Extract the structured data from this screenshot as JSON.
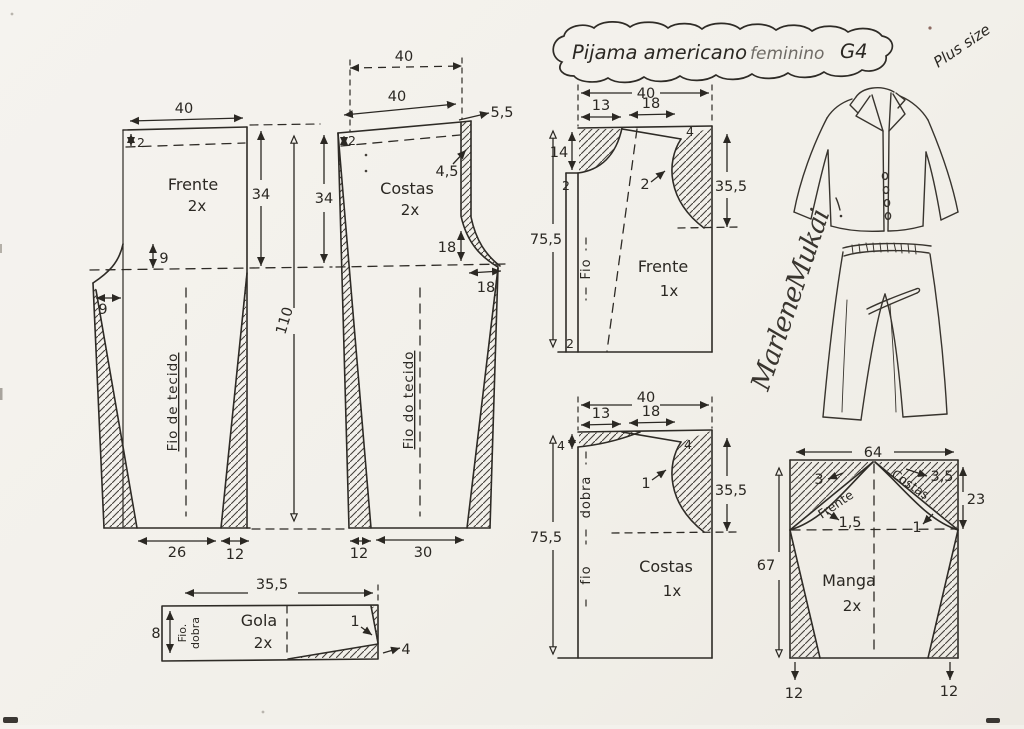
{
  "title": {
    "name": "Pijama americano",
    "audience": "feminino",
    "size": "G4",
    "plus": "Plus size"
  },
  "signature": "MarleneMukai",
  "pants_front": {
    "label": "Frente",
    "qty": "2x",
    "grain": "Fio de tecido",
    "waist": "40",
    "casing": "2",
    "hip_curve": "9",
    "crotch_ext": "9",
    "side": "34",
    "length": "110",
    "hem": "26",
    "hem_cut": "12"
  },
  "pants_back": {
    "label": "Costas",
    "qty": "2x",
    "grain": "Fio do tecido",
    "waist_guide": "40",
    "waist": "40",
    "rise_ext": "5,5",
    "seam_drop": "4,5",
    "casing": "2",
    "side": "34",
    "hip_curve": "18",
    "crotch_ext": "18",
    "hem_cut": "12",
    "hem": "30"
  },
  "top_front": {
    "label": "Frente",
    "qty": "1x",
    "grain": "Fio",
    "width": "40",
    "neck_width": "13",
    "shoulder": "18",
    "shoulder_drop": "4",
    "neck_depth": "14",
    "placket": "2",
    "armhole_note": "2",
    "side": "35,5",
    "length": "75,5",
    "hem_note": "2"
  },
  "top_back": {
    "label": "Costas",
    "qty": "1x",
    "fold": "dobra",
    "grain": "fio",
    "width": "40",
    "neck_width": "13",
    "shoulder": "18",
    "shoulder_drop": "4",
    "neck_depth": "4",
    "armhole_note": "1",
    "side": "35,5",
    "length": "75,5"
  },
  "sleeve": {
    "label": "Manga",
    "qty": "2x",
    "width": "64",
    "front_curve": "Frente",
    "back_curve": "Costas",
    "cap_front": "3",
    "cap_back": "3,5",
    "notch_front": "1,5",
    "notch_back": "1",
    "cap_height": "23",
    "length": "67",
    "hem_left": "12",
    "hem_right": "12"
  },
  "collar": {
    "label": "Gola",
    "qty": "2x",
    "grain": "Fio.",
    "fold": "dobra",
    "width": "35,5",
    "height": "8",
    "tip": "1",
    "end": "4"
  }
}
